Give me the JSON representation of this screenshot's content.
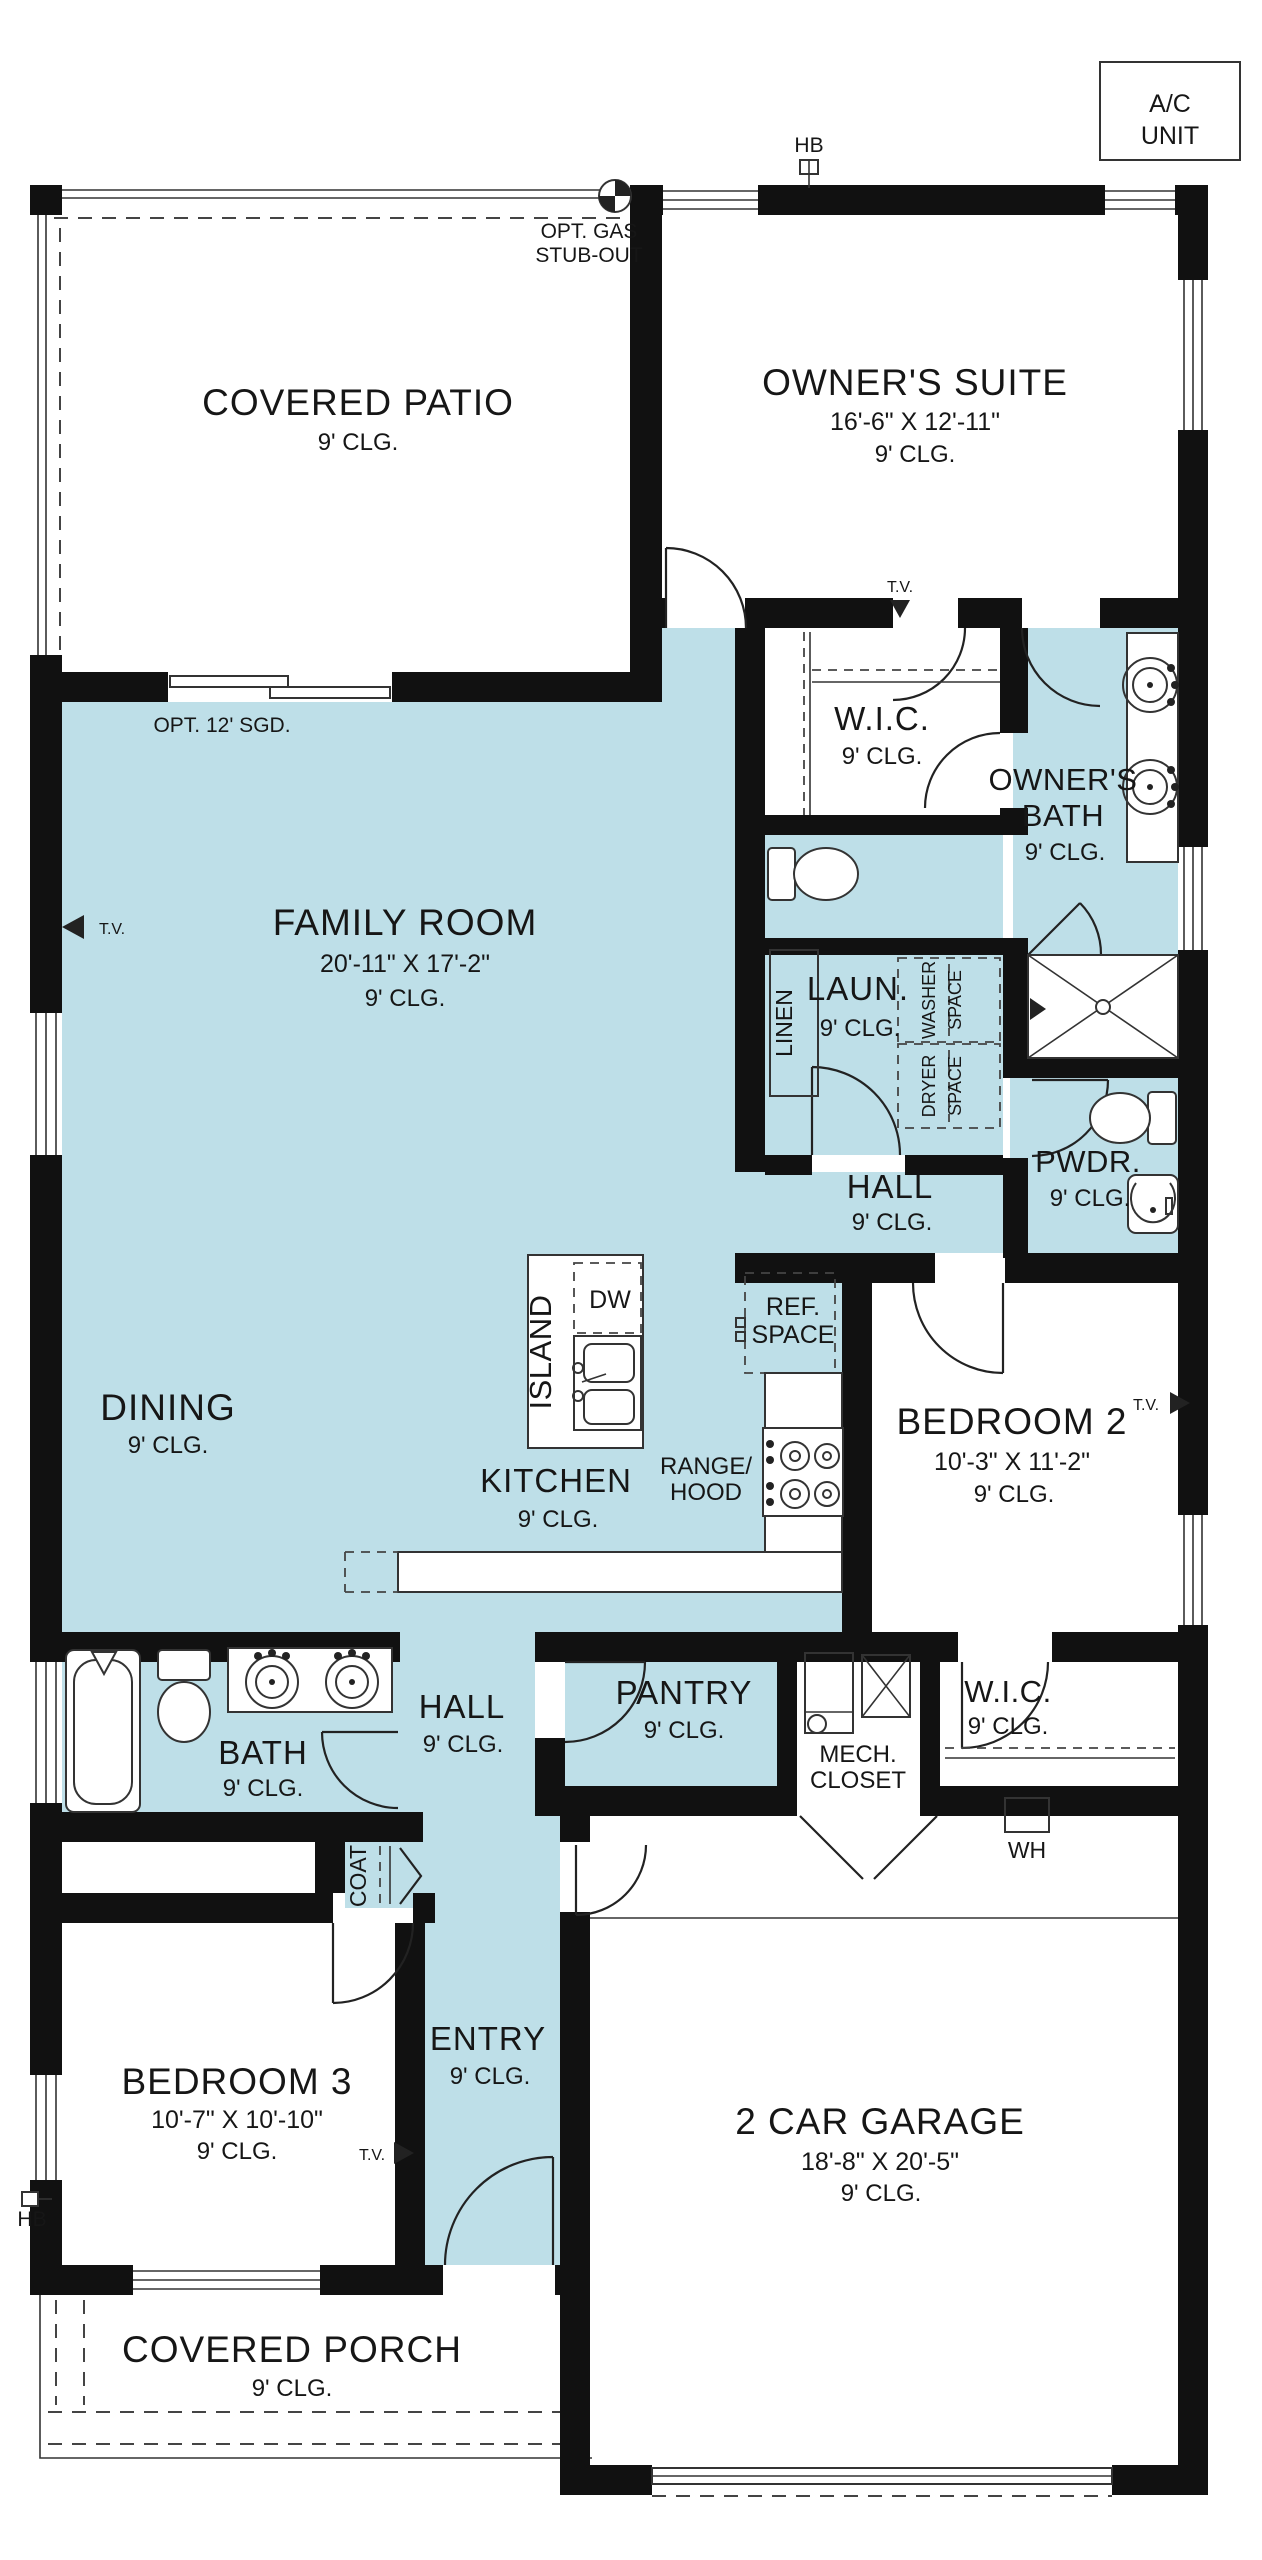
{
  "colors": {
    "room_fill": "#bedfe8",
    "wall": "#111111",
    "line": "#333333"
  },
  "annotations": {
    "ac_unit_line1": "A/C",
    "ac_unit_line2": "UNIT",
    "hose_bib": "HB",
    "tv_marker": "T.V.",
    "water_heater": "WH",
    "opt_gas_line1": "OPT. GAS",
    "opt_gas_line2": "STUB-OUT",
    "opt_sliding_door": "OPT. 12' SGD."
  },
  "rooms": {
    "covered_patio": {
      "name": "COVERED PATIO",
      "ceiling": "9' CLG."
    },
    "owners_suite": {
      "name": "OWNER'S SUITE",
      "dimensions": "16'-6\" X 12'-11\"",
      "ceiling": "9' CLG."
    },
    "wic_owners": {
      "name": "W.I.C.",
      "ceiling": "9' CLG."
    },
    "owners_bath": {
      "name_line1": "OWNER'S",
      "name_line2": "BATH",
      "ceiling": "9' CLG."
    },
    "family_room": {
      "name": "FAMILY ROOM",
      "dimensions": "20'-11\" X 17'-2\"",
      "ceiling": "9' CLG."
    },
    "linen": {
      "name": "LINEN"
    },
    "laundry": {
      "name": "LAUN.",
      "ceiling": "9' CLG."
    },
    "hall_upper": {
      "name": "HALL",
      "ceiling": "9' CLG."
    },
    "powder": {
      "name": "PWDR.",
      "ceiling": "9' CLG."
    },
    "dining": {
      "name": "DINING",
      "ceiling": "9' CLG."
    },
    "kitchen": {
      "name": "KITCHEN",
      "ceiling": "9' CLG."
    },
    "bedroom2": {
      "name": "BEDROOM 2",
      "dimensions": "10'-3\" X 11'-2\"",
      "ceiling": "9' CLG."
    },
    "bath": {
      "name": "BATH",
      "ceiling": "9' CLG."
    },
    "hall_lower": {
      "name": "HALL",
      "ceiling": "9' CLG."
    },
    "pantry": {
      "name": "PANTRY",
      "ceiling": "9' CLG."
    },
    "mech_closet": {
      "name_line1": "MECH.",
      "name_line2": "CLOSET"
    },
    "wic_bedroom2": {
      "name": "W.I.C.",
      "ceiling": "9' CLG."
    },
    "coat": {
      "name": "COAT"
    },
    "entry": {
      "name": "ENTRY",
      "ceiling": "9' CLG."
    },
    "bedroom3": {
      "name": "BEDROOM 3",
      "dimensions": "10'-7\" X 10'-10\"",
      "ceiling": "9' CLG."
    },
    "garage": {
      "name": "2 CAR GARAGE",
      "dimensions": "18'-8\" X 20'-5\"",
      "ceiling": "9' CLG."
    },
    "covered_porch": {
      "name": "COVERED PORCH",
      "ceiling": "9' CLG."
    }
  },
  "fixtures": {
    "island": "ISLAND",
    "dishwasher": "DW",
    "ref_line1": "REF.",
    "ref_line2": "SPACE",
    "range_line1": "RANGE/",
    "range_line2": "HOOD",
    "washer_line1": "WASHER",
    "washer_line2": "SPACE",
    "dryer_line1": "DRYER",
    "dryer_line2": "SPACE"
  }
}
